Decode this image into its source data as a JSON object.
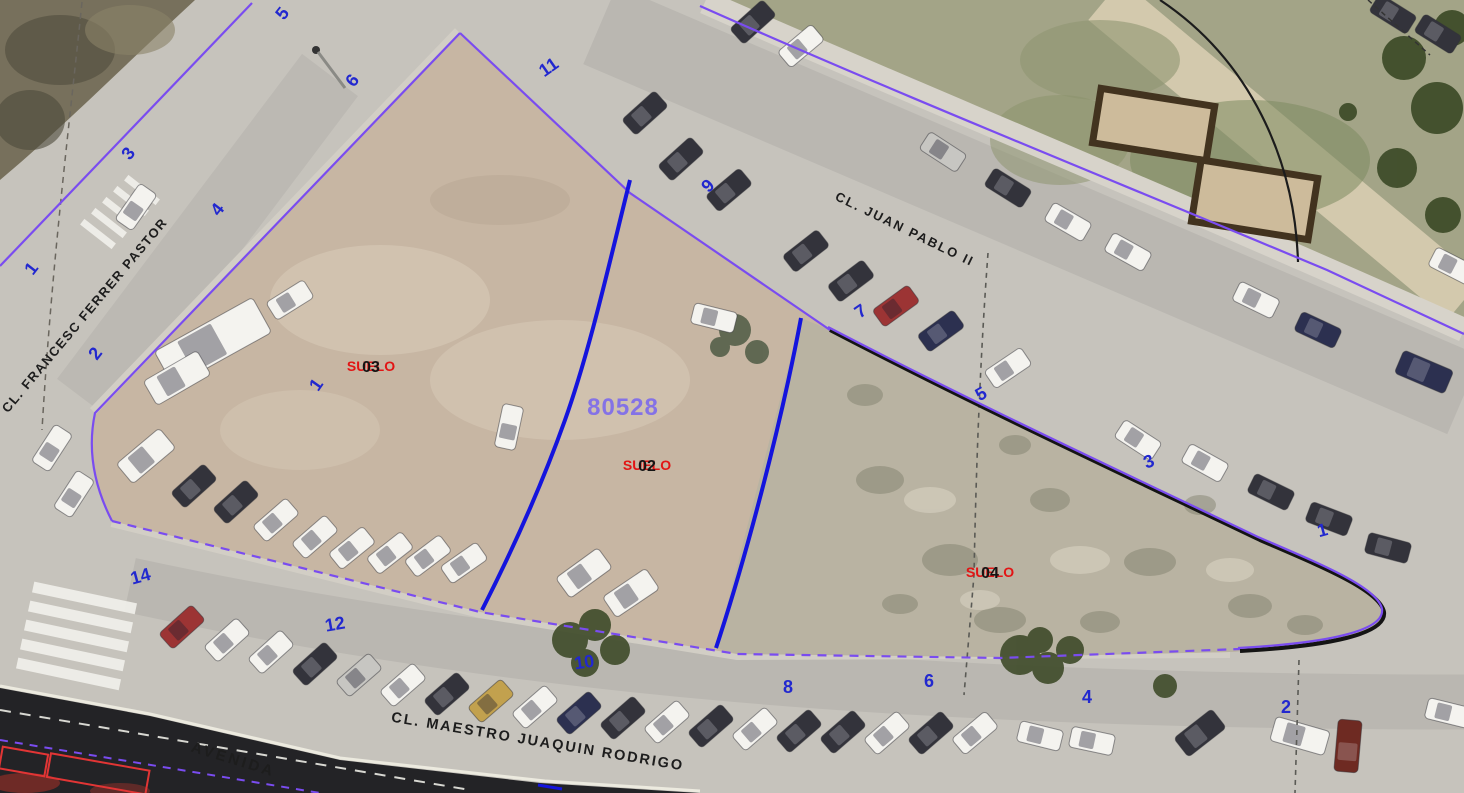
{
  "map": {
    "type": "cadastral-aerial-view",
    "parcel": {
      "number": "80528"
    },
    "subparcels": [
      {
        "label": "SUELO",
        "code": "03",
        "x": 371,
        "y": 371
      },
      {
        "label": "SUELO",
        "code": "02",
        "x": 647,
        "y": 470
      },
      {
        "label": "SUELO",
        "code": "04",
        "x": 990,
        "y": 577
      }
    ],
    "street_names": [
      {
        "text": "CL. JUAN PABLO II",
        "x": 903,
        "y": 233,
        "rotate": 26,
        "size": 13,
        "spacing": 2
      },
      {
        "text": "CL. FRANCESC FERRER PASTOR",
        "x": 88,
        "y": 318,
        "rotate": -50,
        "size": 13,
        "spacing": 1.5
      },
      {
        "text": "CL. MAESTRO JUAQUIN RODRIGO",
        "x": 537,
        "y": 746,
        "rotate": 9.5,
        "size": 14.5,
        "spacing": 2
      },
      {
        "text": "AVENIDA",
        "x": 232,
        "y": 764,
        "rotate": 17,
        "size": 15,
        "spacing": 3
      }
    ],
    "house_numbers": [
      {
        "text": "5",
        "x": 287,
        "y": 17,
        "r": -52
      },
      {
        "text": "6",
        "x": 357,
        "y": 84,
        "r": -52
      },
      {
        "text": "3",
        "x": 133,
        "y": 157,
        "r": -52
      },
      {
        "text": "4",
        "x": 222,
        "y": 213,
        "r": -52
      },
      {
        "text": "1",
        "x": 36,
        "y": 272,
        "r": -52
      },
      {
        "text": "2",
        "x": 100,
        "y": 357,
        "r": -52
      },
      {
        "text": "11",
        "x": 552,
        "y": 72,
        "r": -35
      },
      {
        "text": "9",
        "x": 712,
        "y": 190,
        "r": -45
      },
      {
        "text": "1",
        "x": 321,
        "y": 388,
        "r": -55
      },
      {
        "text": "7",
        "x": 864,
        "y": 316,
        "r": -35
      },
      {
        "text": "5",
        "x": 984,
        "y": 399,
        "r": -30
      },
      {
        "text": "3",
        "x": 1151,
        "y": 467,
        "r": -22
      },
      {
        "text": "1",
        "x": 1324,
        "y": 536,
        "r": -15
      },
      {
        "text": "14",
        "x": 142,
        "y": 582,
        "r": -15
      },
      {
        "text": "12",
        "x": 336,
        "y": 630,
        "r": -10
      },
      {
        "text": "10",
        "x": 585,
        "y": 668,
        "r": -8
      },
      {
        "text": "8",
        "x": 788,
        "y": 693,
        "r": 0
      },
      {
        "text": "6",
        "x": 929,
        "y": 687,
        "r": 0
      },
      {
        "text": "4",
        "x": 1087,
        "y": 703,
        "r": 0
      },
      {
        "text": "2",
        "x": 1286,
        "y": 713,
        "r": 0
      }
    ],
    "colors": {
      "boundary": "#7a4cf0",
      "subdivision": "#1414dd",
      "house_number": "#2228cf",
      "landuse": "#e21414",
      "parcel_number": "#8472e6",
      "street_text": "#1d1d1d",
      "emphasis_line": "#141414"
    },
    "vehicle_colors": {
      "white": "#f4f3ef",
      "silver": "#c7c6c2",
      "dark": "#33333b",
      "darkblue": "#2c3050",
      "red": "#9c3434",
      "gold": "#c2a14e",
      "darkred": "#6e2a22"
    },
    "vehicles": [
      [
        136,
        207,
        -55,
        "white"
      ],
      [
        52,
        448,
        -57,
        "white"
      ],
      [
        74,
        494,
        -57,
        "white"
      ],
      [
        290,
        300,
        -32,
        "white"
      ],
      [
        213,
        342,
        -29,
        "white",
        112,
        40
      ],
      [
        177,
        378,
        -30,
        "white",
        62,
        28
      ],
      [
        146,
        456,
        -40,
        "white",
        56,
        26
      ],
      [
        194,
        486,
        -42,
        "dark"
      ],
      [
        236,
        502,
        -42,
        "dark"
      ],
      [
        276,
        520,
        -41,
        "white"
      ],
      [
        315,
        537,
        -41,
        "white"
      ],
      [
        352,
        548,
        -39,
        "white"
      ],
      [
        390,
        553,
        -38,
        "white"
      ],
      [
        428,
        556,
        -37,
        "white"
      ],
      [
        464,
        563,
        -35,
        "white"
      ],
      [
        714,
        318,
        14,
        "white"
      ],
      [
        509,
        427,
        -78,
        "white"
      ],
      [
        584,
        573,
        -36,
        "white",
        52,
        25
      ],
      [
        631,
        593,
        -34,
        "white",
        52,
        25
      ],
      [
        753,
        22,
        -42,
        "dark"
      ],
      [
        801,
        46,
        -40,
        "white"
      ],
      [
        645,
        113,
        -42,
        "dark"
      ],
      [
        681,
        159,
        -42,
        "dark"
      ],
      [
        729,
        190,
        -40,
        "dark"
      ],
      [
        806,
        251,
        -38,
        "dark"
      ],
      [
        851,
        281,
        -37,
        "dark"
      ],
      [
        896,
        306,
        -36,
        "red"
      ],
      [
        941,
        331,
        -36,
        "darkblue"
      ],
      [
        1008,
        368,
        -34,
        "white"
      ],
      [
        943,
        152,
        33,
        "silver"
      ],
      [
        1008,
        188,
        32,
        "dark"
      ],
      [
        1068,
        222,
        30,
        "white"
      ],
      [
        1128,
        252,
        29,
        "white"
      ],
      [
        1256,
        300,
        26,
        "white"
      ],
      [
        1318,
        330,
        25,
        "darkblue"
      ],
      [
        1424,
        372,
        23,
        "darkblue",
        54,
        25
      ],
      [
        1452,
        266,
        27,
        "white"
      ],
      [
        1393,
        14,
        32,
        "dark"
      ],
      [
        1438,
        34,
        32,
        "dark"
      ],
      [
        1138,
        440,
        33,
        "white"
      ],
      [
        1205,
        463,
        29,
        "white"
      ],
      [
        1271,
        492,
        26,
        "dark"
      ],
      [
        1329,
        519,
        21,
        "dark"
      ],
      [
        1388,
        548,
        15,
        "dark"
      ],
      [
        182,
        627,
        -42,
        "red"
      ],
      [
        227,
        640,
        -42,
        "white"
      ],
      [
        271,
        652,
        -42,
        "white"
      ],
      [
        315,
        664,
        -42,
        "dark"
      ],
      [
        359,
        675,
        -41,
        "silver"
      ],
      [
        403,
        685,
        -41,
        "white"
      ],
      [
        447,
        694,
        -41,
        "dark"
      ],
      [
        491,
        701,
        -41,
        "gold"
      ],
      [
        535,
        707,
        -41,
        "white"
      ],
      [
        579,
        713,
        -41,
        "darkblue"
      ],
      [
        623,
        718,
        -41,
        "dark"
      ],
      [
        667,
        722,
        -41,
        "white"
      ],
      [
        711,
        726,
        -41,
        "dark"
      ],
      [
        755,
        729,
        -41,
        "white"
      ],
      [
        799,
        731,
        -41,
        "dark"
      ],
      [
        843,
        732,
        -41,
        "dark"
      ],
      [
        887,
        733,
        -41,
        "white"
      ],
      [
        931,
        733,
        -41,
        "dark"
      ],
      [
        975,
        733,
        -40,
        "white"
      ],
      [
        1040,
        736,
        14,
        "white"
      ],
      [
        1092,
        741,
        12,
        "white"
      ],
      [
        1200,
        733,
        -38,
        "dark",
        48,
        24
      ],
      [
        1300,
        736,
        16,
        "white",
        56,
        25
      ],
      [
        1348,
        746,
        -85,
        "darkred",
        52,
        24
      ],
      [
        1448,
        713,
        14,
        "white"
      ]
    ]
  }
}
